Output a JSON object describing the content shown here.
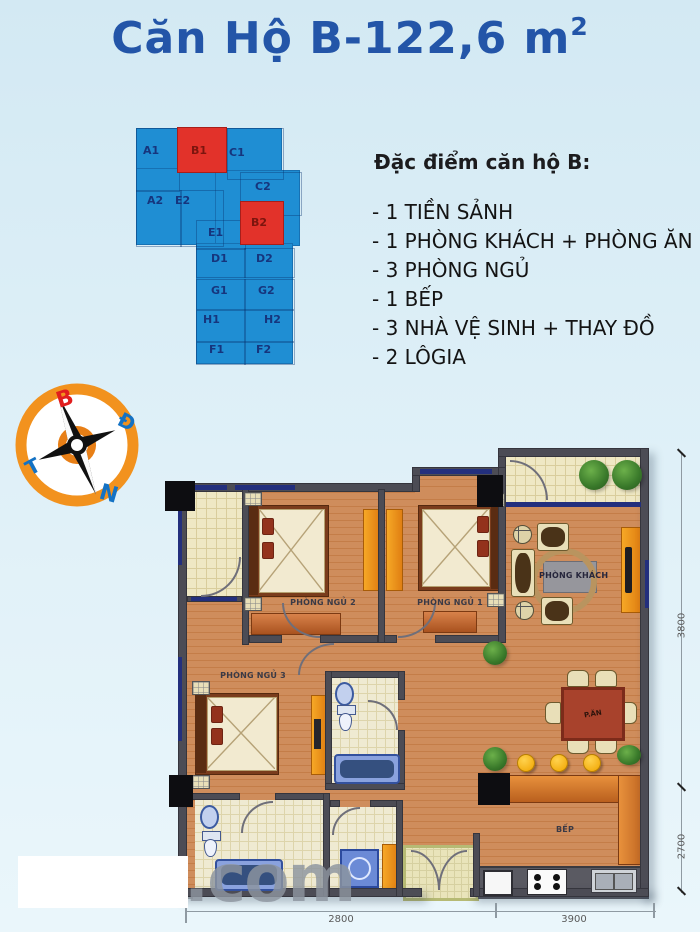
{
  "title": {
    "main": "Căn Hộ B-122,6 m",
    "sup": "2"
  },
  "minimap": {
    "units": [
      "A1",
      "B1",
      "C1",
      "A2",
      "E2",
      "C2",
      "E1",
      "B2",
      "D1",
      "D2",
      "G1",
      "G2",
      "H1",
      "H2",
      "F1",
      "F2"
    ],
    "highlighted": [
      "B1",
      "B2"
    ]
  },
  "features": {
    "heading": "Đặc điểm căn hộ B:",
    "items": [
      "- 1 TIỀN SẢNH",
      "- 1 PHÒNG KHÁCH + PHÒNG ĂN",
      "- 3 PHÒNG NGỦ",
      "- 1 BẾP",
      "- 3 NHÀ VỆ SINH + THAY ĐỒ",
      "- 2 LÔGIA"
    ]
  },
  "compass": {
    "north": "B",
    "east": "Đ",
    "west": "T",
    "south": "N"
  },
  "plan": {
    "rooms": {
      "bedroom1": "PHÒNG NGỦ 1",
      "bedroom2": "PHÒNG NGỦ 2",
      "bedroom3": "PHÒNG NGỦ 3",
      "living": "PHÒNG KHÁCH",
      "dining": "P.ĂN",
      "kitchen": "BẾP"
    },
    "dimensions": {
      "right_top": "3800",
      "right_bottom": "2700",
      "bottom_left": "2800",
      "bottom_right": "3900"
    }
  },
  "watermark": ".com",
  "colors": {
    "title_blue": "#2355a8",
    "unit_blue": "#1f8ed3",
    "unit_red": "#e2322a",
    "compass_ring_orange": "#f2921e",
    "wood_floor": "#cf8d5c",
    "wall_gray": "#4c4c55",
    "window_navy": "#232f7d",
    "fixture_blue": "#8aa2de",
    "wardrobe_orange": "#f6a826"
  }
}
